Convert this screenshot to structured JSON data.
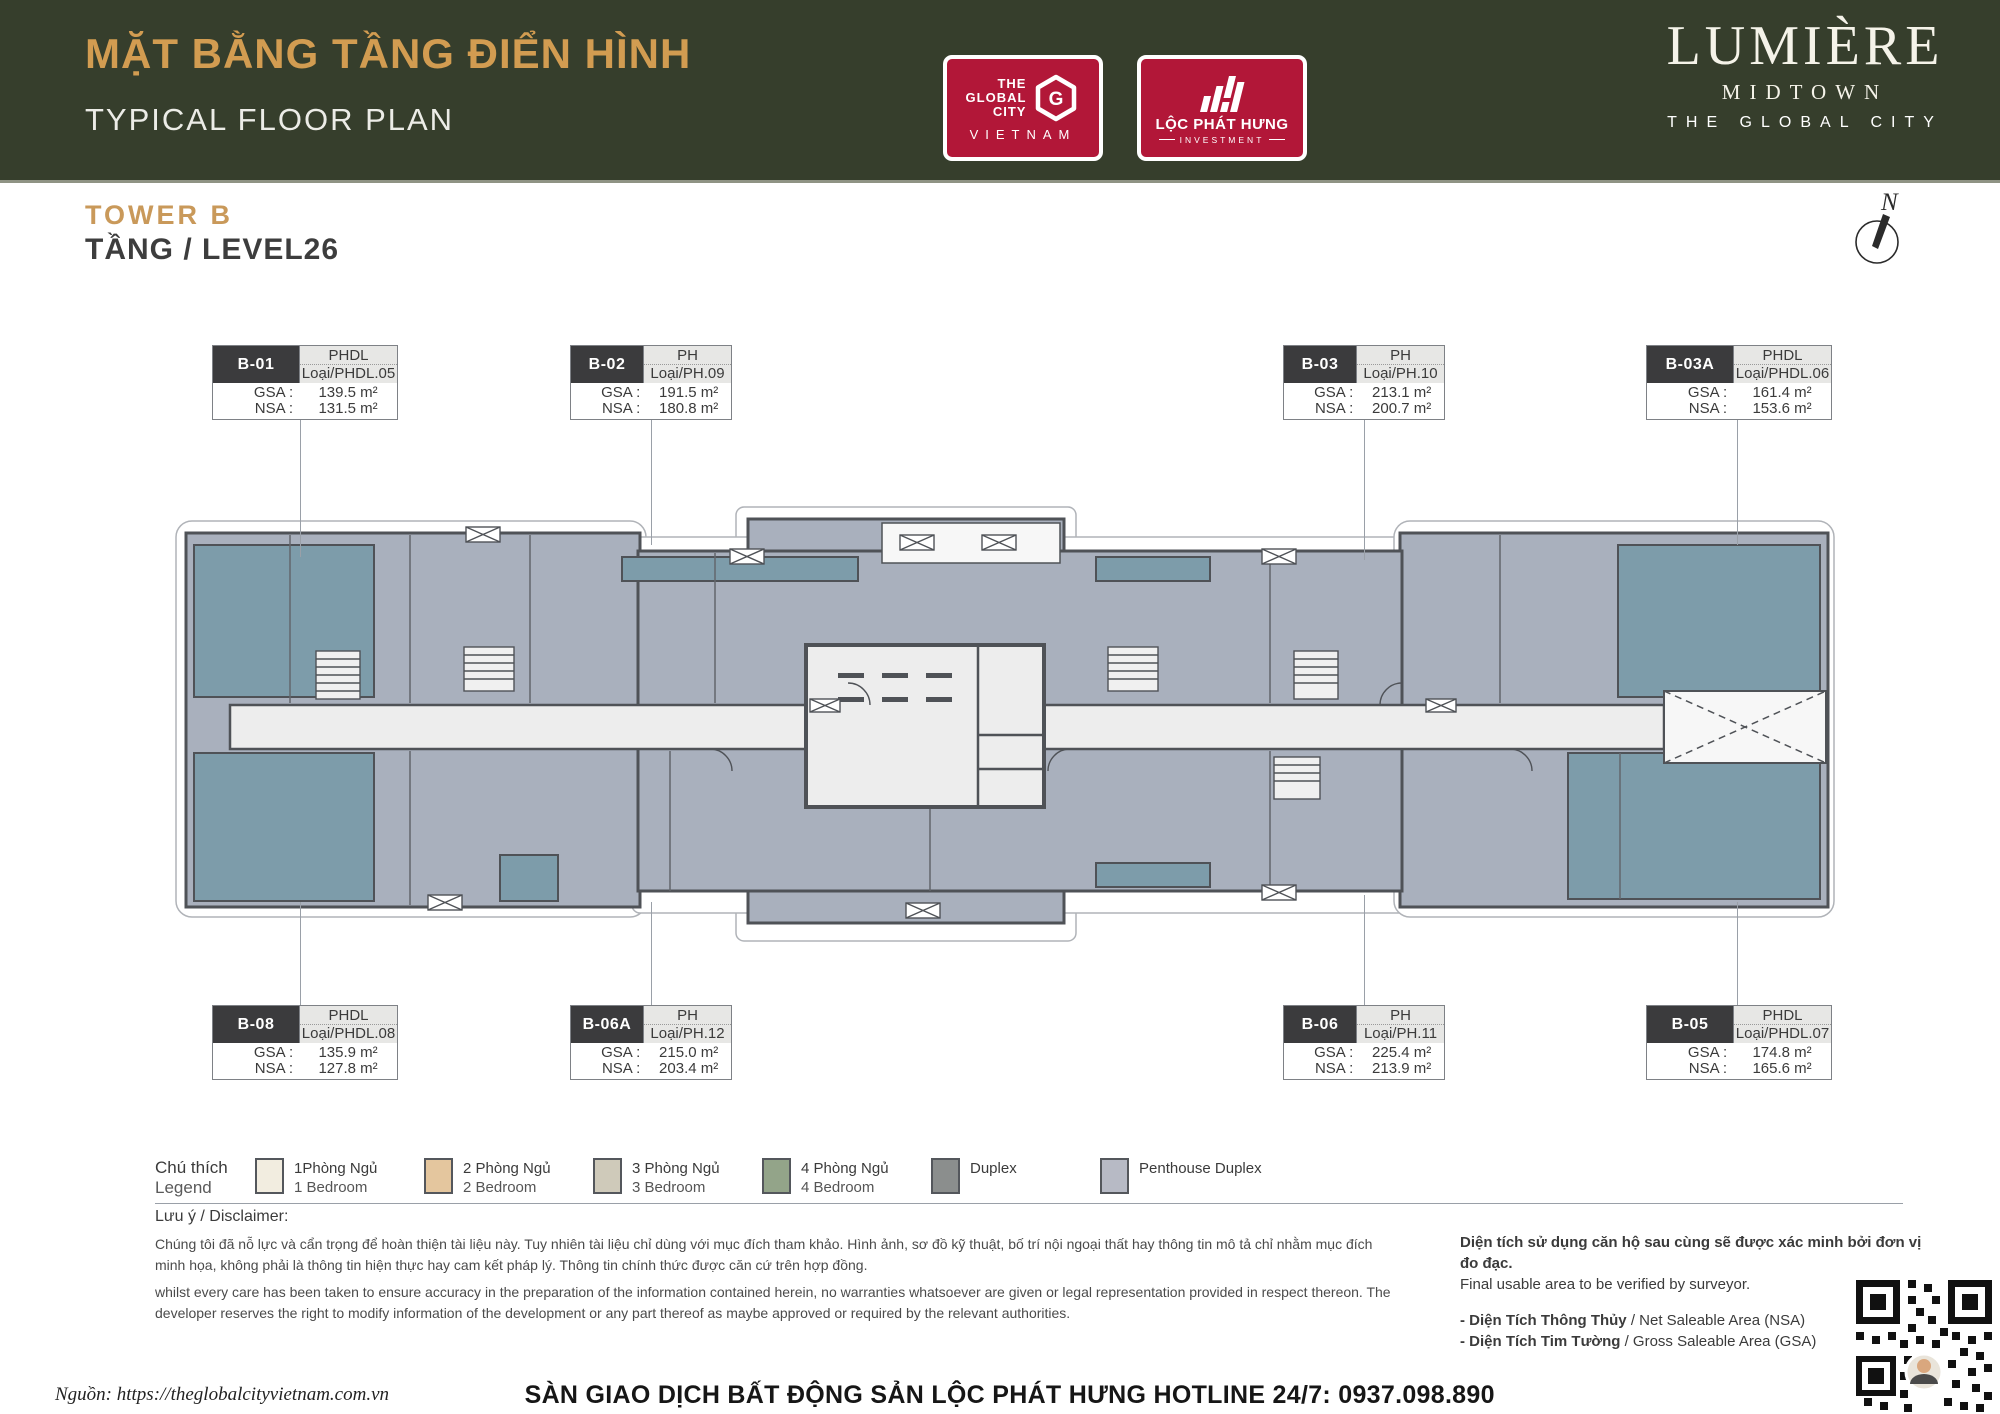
{
  "header": {
    "title_vi": "MẶT BẰNG TẦNG ĐIỂN HÌNH",
    "title_en": "TYPICAL FLOOR PLAN",
    "logos": {
      "global_city": {
        "l1": "THE",
        "l2": "GLOBAL",
        "l3": "CITY",
        "g": "G",
        "bottom": "VIETNAM"
      },
      "loc_phat_hung": {
        "name": "LỘC PHÁT HƯNG",
        "sub": "INVESTMENT"
      }
    },
    "brand": {
      "name": "LUMIÈRE",
      "line2": "MIDTOWN",
      "line3": "THE GLOBAL CITY"
    }
  },
  "floor": {
    "tower": "TOWER B",
    "level": "TẦNG / LEVEL26",
    "compass_label": "N"
  },
  "units": [
    {
      "code": "B-01",
      "type": "PHDL",
      "loai": "Loại/PHDL.05",
      "gsa_label": "GSA :",
      "gsa": "139.5 m²",
      "nsa_label": "NSA :",
      "nsa": "131.5 m²"
    },
    {
      "code": "B-02",
      "type": "PH",
      "loai": "Loại/PH.09",
      "gsa_label": "GSA :",
      "gsa": "191.5 m²",
      "nsa_label": "NSA :",
      "nsa": "180.8 m²"
    },
    {
      "code": "B-03",
      "type": "PH",
      "loai": "Loại/PH.10",
      "gsa_label": "GSA :",
      "gsa": "213.1 m²",
      "nsa_label": "NSA :",
      "nsa": "200.7 m²"
    },
    {
      "code": "B-03A",
      "type": "PHDL",
      "loai": "Loại/PHDL.06",
      "gsa_label": "GSA :",
      "gsa": "161.4 m²",
      "nsa_label": "NSA :",
      "nsa": "153.6 m²"
    },
    {
      "code": "B-08",
      "type": "PHDL",
      "loai": "Loại/PHDL.08",
      "gsa_label": "GSA :",
      "gsa": "135.9 m²",
      "nsa_label": "NSA :",
      "nsa": "127.8 m²"
    },
    {
      "code": "B-06A",
      "type": "PH",
      "loai": "Loại/PH.12",
      "gsa_label": "GSA :",
      "gsa": "215.0 m²",
      "nsa_label": "NSA :",
      "nsa": "203.4 m²"
    },
    {
      "code": "B-06",
      "type": "PH",
      "loai": "Loại/PH.11",
      "gsa_label": "GSA :",
      "gsa": "225.4 m²",
      "nsa_label": "NSA :",
      "nsa": "213.9 m²"
    },
    {
      "code": "B-05",
      "type": "PHDL",
      "loai": "Loại/PHDL.07",
      "gsa_label": "GSA :",
      "gsa": "174.8 m²",
      "nsa_label": "NSA :",
      "nsa": "165.6 m²"
    }
  ],
  "legend": {
    "title_vi": "Chú thích",
    "title_en": "Legend",
    "items": [
      {
        "color": "#f2ede0",
        "vi": "1Phòng Ngủ",
        "en": "1 Bedroom"
      },
      {
        "color": "#e4c69e",
        "vi": "2 Phòng Ngủ",
        "en": "2 Bedroom"
      },
      {
        "color": "#cfcaba",
        "vi": "3 Phòng Ngủ",
        "en": "3 Bedroom"
      },
      {
        "color": "#93a489",
        "vi": "4 Phòng Ngủ",
        "en": "4 Bedroom"
      },
      {
        "color": "#8b8e8d",
        "vi": "Duplex",
        "en": ""
      },
      {
        "color": "#b7bac5",
        "vi": "Penthouse Duplex",
        "en": ""
      }
    ]
  },
  "notes": {
    "disclaimer_heading": "Lưu ý / Disclaimer:",
    "disclaimer_vi": "Chúng tôi đã nỗ lực và cẩn trọng để hoàn thiện tài liệu này. Tuy nhiên tài liệu chỉ dùng với mục đích tham khảo. Hình ảnh, sơ đồ kỹ thuật, bố trí nội ngoại thất hay thông tin mô tả chỉ nhằm mục đích minh họa, không phải là thông tin hiện thực hay cam kết pháp lý. Thông tin chính thức được căn cứ trên hợp đồng.",
    "disclaimer_en": "whilst every care has been taken to ensure accuracy in the preparation of the information contained herein, no warranties whatsoever are given or legal representation provided in respect thereon. The developer reserves the right to modify information of the development or any part thereof as maybe approved or required by the relevant authorities.",
    "area_vi": "Diện tích sử dụng căn hộ sau cùng sẽ được xác minh bởi đơn vị đo đạc.",
    "area_en": "Final usable area to be verified by surveyor.",
    "nsa_vi": "- Diện Tích Thông Thủy",
    "nsa_en": " / Net Saleable Area (NSA)",
    "gsa_vi": "- Diện Tích Tim Tường",
    "gsa_en": " / Gross Saleable Area (GSA)"
  },
  "footer": {
    "source": "Nguồn: https://theglobalcityvietnam.com.vn",
    "hotline": "SÀN GIAO DỊCH BẤT ĐỘNG SẢN LỘC PHÁT HƯNG HOTLINE 24/7: 0937.098.890"
  },
  "colors": {
    "header_bg": "#363e2c",
    "gold": "#d29c51",
    "logo_red": "#b21738",
    "plan_gray": "#a9b0bd",
    "plan_teal": "#7d9caa",
    "corridor": "#ededed",
    "wall": "#4f5257"
  }
}
